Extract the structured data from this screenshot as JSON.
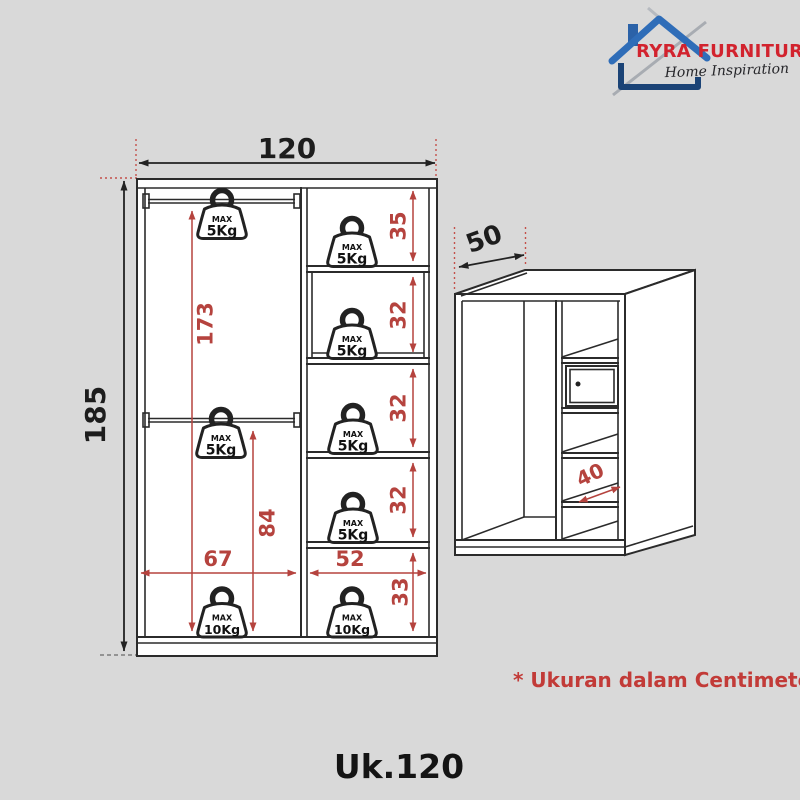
{
  "logo": {
    "brand": "RYRA FURNITURE",
    "tagline": "Home Inspiration"
  },
  "front_view": {
    "overall_width": "120",
    "overall_height": "185",
    "rod_to_floor": "173",
    "mid_rod_to_floor": "84",
    "left_section_width": "67",
    "right_section_width": "52",
    "compartments": [
      "35",
      "32",
      "32",
      "32",
      "33"
    ]
  },
  "side_view": {
    "depth": "50",
    "shelf_depth": "40"
  },
  "weights": [
    {
      "max": "MAX",
      "value": "5Kg"
    },
    {
      "max": "MAX",
      "value": "5Kg"
    },
    {
      "max": "MAX",
      "value": "5Kg"
    },
    {
      "max": "MAX",
      "value": "5Kg"
    },
    {
      "max": "MAX",
      "value": "5Kg"
    },
    {
      "max": "MAX",
      "value": "5Kg"
    },
    {
      "max": "MAX",
      "value": "10Kg"
    },
    {
      "max": "MAX",
      "value": "10Kg"
    }
  ],
  "note": "* Ukuran dalam Centimeter",
  "caption": "Uk.120",
  "colors": {
    "background": "#d9d9d9",
    "line_black": "#2b2b2b",
    "dimension_red": "#b5433e",
    "note_red": "#c23b38",
    "brand_red": "#d2232e",
    "brand_blue": "#2b62a8"
  }
}
